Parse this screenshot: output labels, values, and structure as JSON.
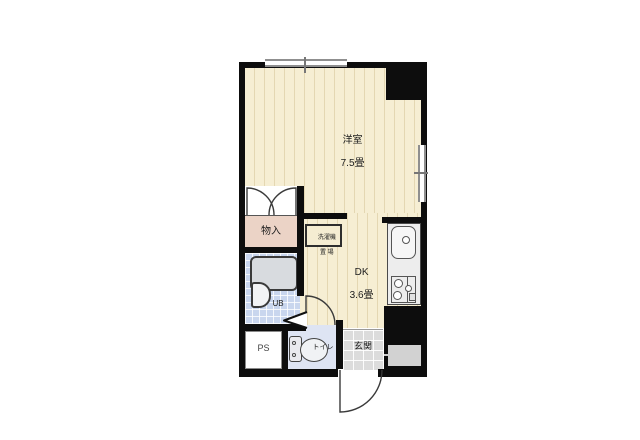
{
  "plan": {
    "title": "apartment-floorplan",
    "rooms": {
      "yoshitsu": {
        "label": "洋室",
        "size": "7.5畳"
      },
      "dk": {
        "label": "DK",
        "size": "3.6畳"
      },
      "monoire": {
        "label": "物入"
      },
      "washer": {
        "line1": "洗濯機",
        "line2": "置 場"
      },
      "ub": {
        "label": "UB"
      },
      "ps": {
        "label": "PS"
      },
      "toilet": {
        "label": "トイレ"
      },
      "genkan": {
        "label": "玄関"
      }
    },
    "colors": {
      "wall": "#0d0d0d",
      "floor": "#f6eed3",
      "floor_stripe": "#e4d7b2",
      "closet": "#ebd3c6",
      "bath": "#c9d6ee",
      "toilet_floor": "#dee4f3",
      "entry_tile": "#dcdcdc",
      "counter": "#ededed",
      "window": "#8f8f8f"
    }
  }
}
